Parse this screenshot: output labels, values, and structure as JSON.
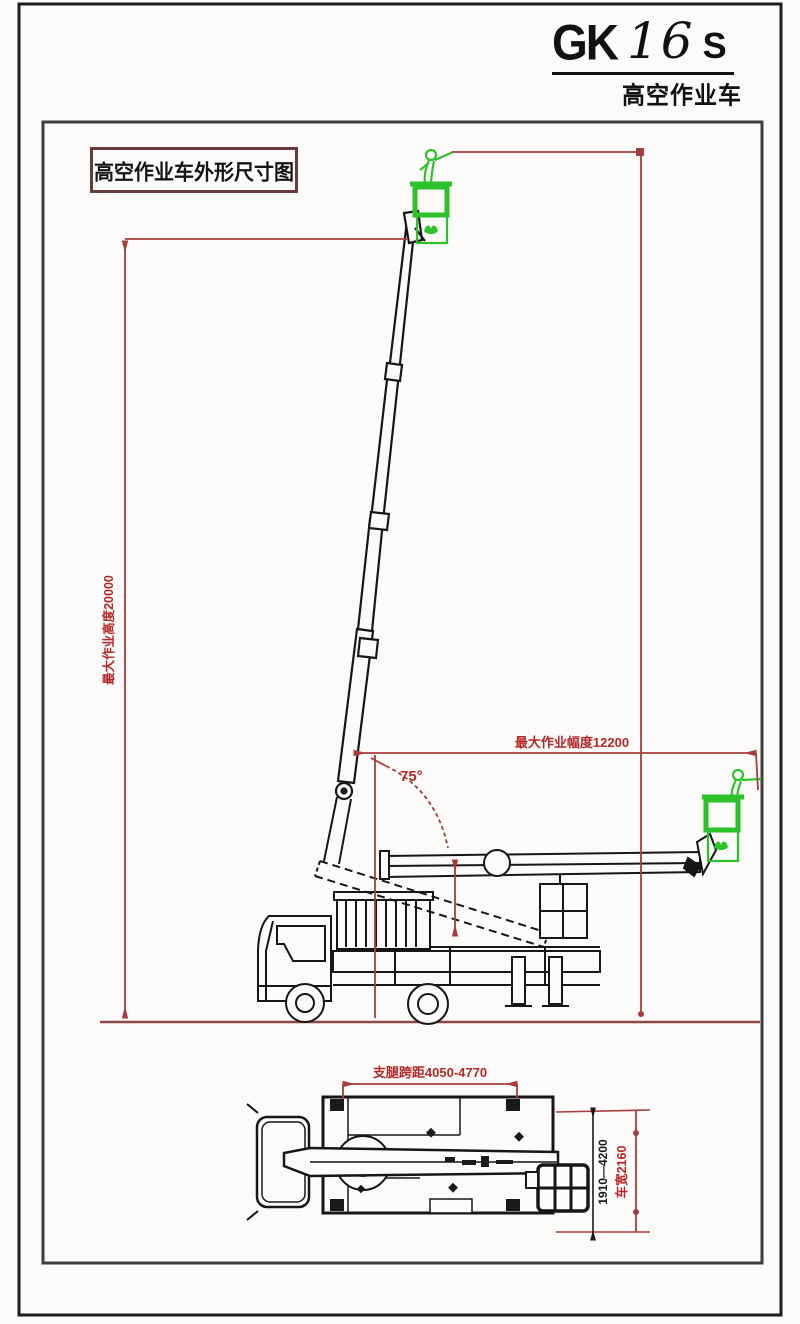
{
  "header": {
    "logo_gk": "GK",
    "logo_16": "16",
    "logo_s": "S",
    "logo_subtitle": "高空作业车"
  },
  "drawing": {
    "title": "高空作业车外形尺寸图"
  },
  "side_view": {
    "max_height_label": "最大作业高度20000",
    "max_radius_label": "最大作业幅度12200",
    "boom_angle_label": "75°"
  },
  "top_view": {
    "outrigger_span_label": "支腿跨距4050-4770",
    "slew_range_label": "1910—4200",
    "width_label": "车宽2160"
  },
  "colors": {
    "dimension_red": "#a83c3c",
    "label_red": "#b52828",
    "basket_green": "#2cc22c",
    "line_black": "#161616",
    "ground_maroon": "#8f4848"
  }
}
